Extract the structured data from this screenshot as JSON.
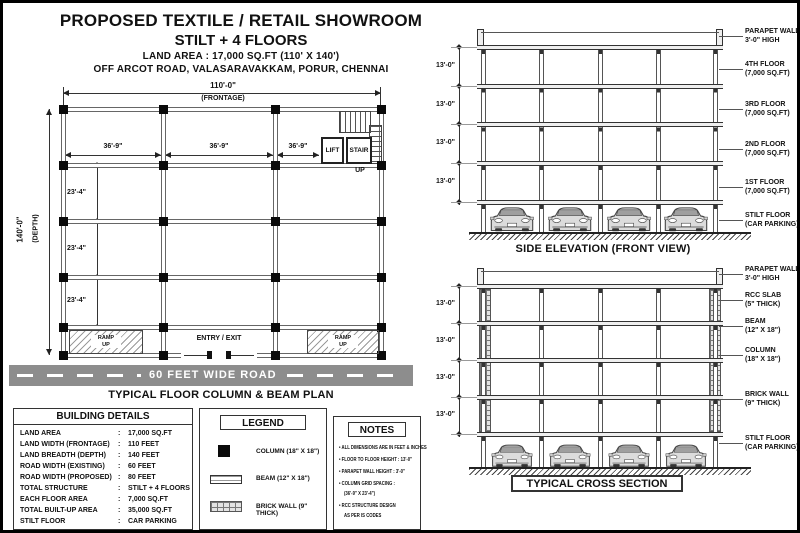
{
  "title_block": {
    "line1": "PROPOSED TEXTILE / RETAIL SHOWROOM",
    "line2": "STILT + 4 FLOORS",
    "line3": "LAND AREA : 17,000 SQ.FT (110' X 140')",
    "line4": "OFF ARCOT ROAD, VALASARAVAKKAM, PORUR, CHENNAI"
  },
  "colors": {
    "road_gray": "#8d8d8d",
    "ink": "#111111",
    "paper": "#ffffff"
  },
  "dims": {
    "floor_height": "13'-0\""
  },
  "plan": {
    "frontage_dim": "110'-0\"",
    "frontage_label": "(FRONTAGE)",
    "depth_dim": "140'-0\"",
    "depth_label": "(DEPTH)",
    "bay_width": "36'-9\"",
    "bay_depth": "23'-4\"",
    "lift": "LIFT",
    "stair": "STAIR",
    "up": "UP",
    "ramp_line1": "RAMP",
    "ramp_line2": "UP",
    "entry": "ENTRY / EXIT",
    "road": "60 FEET WIDE ROAD",
    "caption": "TYPICAL FLOOR COLUMN & BEAM PLAN"
  },
  "side_elevation": {
    "caption": "SIDE ELEVATION (FRONT VIEW)",
    "labels": [
      {
        "l1": "PARAPET WALL",
        "l2": "3'-0\" HIGH"
      },
      {
        "l1": "4TH FLOOR",
        "l2": "(7,000 SQ.FT)"
      },
      {
        "l1": "3RD FLOOR",
        "l2": "(7,000 SQ.FT)"
      },
      {
        "l1": "2ND FLOOR",
        "l2": "(7,000 SQ.FT)"
      },
      {
        "l1": "1ST FLOOR",
        "l2": "(7,000 SQ.FT)"
      },
      {
        "l1": "STILT FLOOR",
        "l2": "(CAR PARKING)"
      }
    ]
  },
  "cross_section": {
    "caption": "TYPICAL CROSS SECTION",
    "labels": [
      {
        "l1": "PARAPET WALL",
        "l2": "3'-0\" HIGH"
      },
      {
        "l1": "RCC SLAB",
        "l2": "(5\" THICK)"
      },
      {
        "l1": "BEAM",
        "l2": "(12\" X 18\")"
      },
      {
        "l1": "COLUMN",
        "l2": "(18\" X 18\")"
      },
      {
        "l1": "BRICK WALL",
        "l2": "(9\" THICK)"
      },
      {
        "l1": "STILT FLOOR",
        "l2": "(CAR PARKING)"
      }
    ]
  },
  "building_details": {
    "title": "BUILDING DETAILS",
    "sep": ":",
    "rows": [
      {
        "label": "LAND AREA",
        "value": "17,000 SQ.FT"
      },
      {
        "label": "LAND WIDTH (FRONTAGE)",
        "value": "110 FEET"
      },
      {
        "label": "LAND BREADTH (DEPTH)",
        "value": "140 FEET"
      },
      {
        "label": "ROAD WIDTH (EXISTING)",
        "value": "60 FEET"
      },
      {
        "label": "ROAD WIDTH (PROPOSED)",
        "value": "80 FEET"
      },
      {
        "label": "TOTAL STRUCTURE",
        "value": "STILT + 4 FLOORS"
      },
      {
        "label": "EACH FLOOR AREA",
        "value": "7,000 SQ.FT"
      },
      {
        "label": "TOTAL BUILT-UP AREA",
        "value": "35,000 SQ.FT"
      },
      {
        "label": "STILT FLOOR",
        "value": "CAR PARKING"
      }
    ]
  },
  "legend": {
    "title": "LEGEND",
    "items": [
      {
        "label": "COLUMN (18\" X 18\")"
      },
      {
        "label": "BEAM (12\" X 18\")"
      },
      {
        "label": "BRICK WALL (9\" THICK)"
      }
    ]
  },
  "notes": {
    "title": "NOTES",
    "lines": [
      {
        "t": "ALL DIMENSIONS ARE IN FEET & INCHES"
      },
      {
        "t": "FLOOR TO FLOOR HEIGHT :  13'-0\""
      },
      {
        "t": "PARAPET WALL HEIGHT  :  3'-0\""
      },
      {
        "t": "COLUMN GRID SPACING :"
      },
      {
        "t": "(36'-9\" X 23'-4\")",
        "cont": true
      },
      {
        "t": "RCC STRUCTURE DESIGN"
      },
      {
        "t": "AS PER IS CODES",
        "cont": true
      }
    ]
  }
}
